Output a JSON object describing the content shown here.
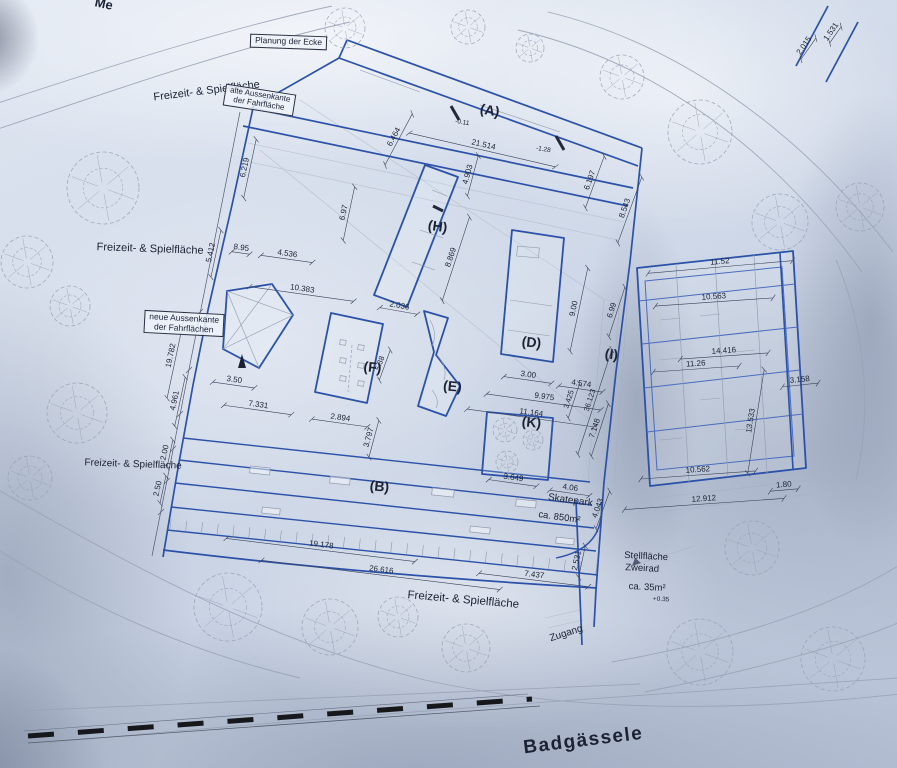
{
  "colors": {
    "plan_blue": "#2b51a8",
    "thin_blue": "#4a6cc0",
    "sketch_gray": "#97a0b4",
    "ink": "#1c2233",
    "dimline": "#39415a",
    "paper": "#ccd6e6",
    "rail_black": "#17181c"
  },
  "plan": {
    "boxes": {
      "planung": {
        "label": "Planung der Ecke"
      },
      "alte": {
        "line1": "alte Aussenkante",
        "line2": "der Fahrfläche"
      },
      "neue": {
        "line1": "neue Aussenkante",
        "line2": "der Fahrflächen"
      }
    },
    "texts": [
      {
        "n": "street-name-top",
        "t": "Me",
        "x": 103,
        "y": 8,
        "r": 12,
        "s": 13,
        "w": 700
      },
      {
        "n": "area-label-top",
        "t": "Freizeit- & Spielfläche",
        "x": 207,
        "y": 94,
        "r": -7,
        "s": 11,
        "w": 500
      },
      {
        "n": "area-label-mid",
        "t": "Freizeit- & Spielfläche",
        "x": 150,
        "y": 252,
        "r": 2,
        "s": 11,
        "w": 500
      },
      {
        "n": "area-label-left",
        "t": "Freizeit- & Spielfläche",
        "x": 133,
        "y": 467,
        "r": 2,
        "s": 10,
        "w": 500
      },
      {
        "n": "area-label-bottom",
        "t": "Freizeit- & Spielfläche",
        "x": 463,
        "y": 603,
        "r": 5,
        "s": 11.5,
        "w": 500
      },
      {
        "n": "street-name-bottom",
        "t": "Badgässele",
        "x": 584,
        "y": 746,
        "r": -7,
        "s": 19,
        "w": 600,
        "ls": 1.5
      },
      {
        "n": "zugang-label",
        "t": "Zugang",
        "x": 567,
        "y": 636,
        "r": -18,
        "s": 10,
        "w": 500
      },
      {
        "n": "skatepark-label",
        "t": "Skatepark",
        "x": 570,
        "y": 503,
        "r": 8,
        "s": 10,
        "w": 500
      },
      {
        "n": "skatepark-area",
        "t": "ca. 850m²",
        "x": 559,
        "y": 520,
        "r": 8,
        "s": 9.5,
        "w": 500
      },
      {
        "n": "stellflaeche-line1",
        "t": "Stellfläche",
        "x": 646,
        "y": 559,
        "r": 3,
        "s": 9.5,
        "w": 500
      },
      {
        "n": "stellflaeche-line2",
        "t": "Zweirad",
        "x": 642,
        "y": 571,
        "r": 3,
        "s": 9.5,
        "w": 500
      },
      {
        "n": "stellflaeche-area",
        "t": "ca. 35m²",
        "x": 647,
        "y": 590,
        "r": 3,
        "s": 9.5,
        "w": 500
      },
      {
        "n": "level-note",
        "t": "+0.35",
        "x": 661,
        "y": 601,
        "r": 3,
        "s": 6.5
      },
      {
        "n": "building-label-a",
        "t": "(A)",
        "x": 489,
        "y": 115,
        "r": 10,
        "s": 14,
        "w": 600
      },
      {
        "n": "building-label-b",
        "t": "(B)",
        "x": 379,
        "y": 491,
        "r": 6,
        "s": 14,
        "w": 600
      },
      {
        "n": "building-label-d",
        "t": "(D)",
        "x": 531,
        "y": 347,
        "r": 6,
        "s": 14,
        "w": 600
      },
      {
        "n": "building-label-e",
        "t": "(E)",
        "x": 452,
        "y": 391,
        "r": 6,
        "s": 14,
        "w": 600
      },
      {
        "n": "building-label-f",
        "t": "(F)",
        "x": 372,
        "y": 372,
        "r": 6,
        "s": 14,
        "w": 600
      },
      {
        "n": "building-label-h",
        "t": "(H)",
        "x": 437,
        "y": 231,
        "r": 8,
        "s": 14,
        "w": 600
      },
      {
        "n": "building-label-i",
        "t": "(I)",
        "x": 611,
        "y": 359,
        "r": 6,
        "s": 14,
        "w": 600
      },
      {
        "n": "building-label-k",
        "t": "(K)",
        "x": 531,
        "y": 427,
        "r": 6,
        "s": 14,
        "w": 600
      },
      {
        "n": "dim-2015",
        "t": "2.015",
        "x": 806,
        "y": 47,
        "r": -55,
        "l": 26
      },
      {
        "n": "dim-1531",
        "t": "1.531",
        "x": 833,
        "y": 33,
        "r": -55,
        "l": 20
      },
      {
        "n": "dim-6219",
        "t": "6.219",
        "x": 247,
        "y": 168,
        "r": -78,
        "l": 60
      },
      {
        "n": "dim-6464",
        "t": "6.464",
        "x": 396,
        "y": 138,
        "r": -62,
        "l": 58
      },
      {
        "n": "dim-21514",
        "t": "21.514",
        "x": 483,
        "y": 147,
        "r": 13,
        "l": 150
      },
      {
        "n": "dim-4903",
        "t": "4.903",
        "x": 470,
        "y": 175,
        "r": -75,
        "l": 42
      },
      {
        "n": "level-a1",
        "t": "-0.11",
        "x": 462,
        "y": 124,
        "r": 10,
        "s": 6.5
      },
      {
        "n": "level-a2",
        "t": "-1.28",
        "x": 543,
        "y": 151,
        "r": 10,
        "s": 6.5
      },
      {
        "n": "dim-895",
        "t": "8.95",
        "x": 241,
        "y": 250,
        "r": 8,
        "l": 18
      },
      {
        "n": "dim-4536",
        "t": "4.536",
        "x": 287,
        "y": 256,
        "r": 8,
        "l": 52
      },
      {
        "n": "dim-5412",
        "t": "5.412",
        "x": 213,
        "y": 253,
        "r": -78,
        "l": 48
      },
      {
        "n": "dim-697",
        "t": "6.97",
        "x": 346,
        "y": 213,
        "r": -78,
        "l": 55
      },
      {
        "n": "dim-8869",
        "t": "8.869",
        "x": 453,
        "y": 258,
        "r": -72,
        "l": 88
      },
      {
        "n": "dim-2036",
        "t": "2.036",
        "x": 399,
        "y": 308,
        "r": 10,
        "l": 38
      },
      {
        "n": "dim-10383",
        "t": "10.383",
        "x": 302,
        "y": 291,
        "r": 8,
        "l": 105
      },
      {
        "n": "dim-19782",
        "t": "19.782",
        "x": 173,
        "y": 356,
        "r": -78,
        "l": 85
      },
      {
        "n": "dim-4961",
        "t": "4.961",
        "x": 177,
        "y": 401,
        "r": -78,
        "l": 50
      },
      {
        "n": "dim-200",
        "t": "2.00",
        "x": 167,
        "y": 453,
        "r": -78,
        "l": 28
      },
      {
        "n": "dim-250",
        "t": "2.50",
        "x": 160,
        "y": 489,
        "r": -78,
        "l": 28
      },
      {
        "n": "dim-350",
        "t": "3.50",
        "x": 234,
        "y": 382,
        "r": 8,
        "l": 42
      },
      {
        "n": "dim-7331",
        "t": "7.331",
        "x": 258,
        "y": 407,
        "r": 8,
        "l": 68
      },
      {
        "n": "dim-2894",
        "t": "2.894",
        "x": 340,
        "y": 420,
        "r": 8,
        "l": 56
      },
      {
        "n": "dim-3797",
        "t": "3.797",
        "x": 371,
        "y": 438,
        "r": -75,
        "l": 38
      },
      {
        "n": "dim-538",
        "t": "5.38",
        "x": 382,
        "y": 364,
        "r": -70,
        "s": 7.5,
        "l": 32
      },
      {
        "n": "dim-300",
        "t": "3.00",
        "x": 528,
        "y": 377,
        "r": 8,
        "l": 48
      },
      {
        "n": "dim-9975",
        "t": "9.975",
        "x": 544,
        "y": 399,
        "r": 8,
        "l": 115
      },
      {
        "n": "dim-11164",
        "t": "11.164",
        "x": 531,
        "y": 415,
        "r": 8,
        "l": 128
      },
      {
        "n": "dim-4574",
        "t": "4.574",
        "x": 581,
        "y": 386,
        "r": 8,
        "l": 44
      },
      {
        "n": "dim-36123",
        "t": "36.123",
        "x": 592,
        "y": 401,
        "r": -72,
        "s": 7.5,
        "l": 110
      },
      {
        "n": "dim-3425",
        "t": "3.425",
        "x": 571,
        "y": 400,
        "r": -72,
        "s": 7.5,
        "l": 36
      },
      {
        "n": "dim-7148",
        "t": "7.148",
        "x": 597,
        "y": 429,
        "r": -72,
        "l": 55
      },
      {
        "n": "dim-900",
        "t": "9.00",
        "x": 576,
        "y": 309,
        "r": -78,
        "l": 85
      },
      {
        "n": "dim-699",
        "t": "6.99",
        "x": 614,
        "y": 311,
        "r": -72,
        "l": 52
      },
      {
        "n": "dim-6197",
        "t": "6.197",
        "x": 592,
        "y": 181,
        "r": -70,
        "l": 55
      },
      {
        "n": "dim-8543",
        "t": "8.543",
        "x": 627,
        "y": 209,
        "r": -70,
        "l": 70
      },
      {
        "n": "dim-3649",
        "t": "3.649",
        "x": 513,
        "y": 480,
        "r": 8,
        "l": 48
      },
      {
        "n": "dim-406",
        "t": "4.06",
        "x": 570,
        "y": 490,
        "r": 8,
        "l": 40
      },
      {
        "n": "dim-4043",
        "t": "4.043",
        "x": 600,
        "y": 509,
        "r": -70,
        "l": 40
      },
      {
        "n": "dim-19178",
        "t": "19.178",
        "x": 321,
        "y": 547,
        "r": 7,
        "l": 190
      },
      {
        "n": "dim-26616",
        "t": "26.616",
        "x": 381,
        "y": 572,
        "r": 7,
        "l": 240
      },
      {
        "n": "dim-7437",
        "t": "7.437",
        "x": 534,
        "y": 577,
        "r": 7,
        "l": 110
      },
      {
        "n": "dim-2531",
        "t": "2.531",
        "x": 579,
        "y": 561,
        "r": -78,
        "l": 32
      },
      {
        "n": "dim-1152",
        "t": "11.52",
        "x": 720,
        "y": 264,
        "r": -5,
        "l": 145
      },
      {
        "n": "dim-10563",
        "t": "10.563",
        "x": 714,
        "y": 299,
        "r": -4,
        "l": 118
      },
      {
        "n": "dim-14416",
        "t": "14.416",
        "x": 724,
        "y": 353,
        "r": -4,
        "l": 88
      },
      {
        "n": "dim-1126",
        "t": "11.26",
        "x": 696,
        "y": 366,
        "r": -4,
        "l": 86
      },
      {
        "n": "dim-3158",
        "t": "3.158",
        "x": 800,
        "y": 382,
        "r": -6,
        "l": 36
      },
      {
        "n": "dim-13533",
        "t": "13.533",
        "x": 753,
        "y": 421,
        "r": -81,
        "l": 105
      },
      {
        "n": "dim-10562",
        "t": "10.562",
        "x": 698,
        "y": 472,
        "r": -4,
        "l": 115
      },
      {
        "n": "dim-180",
        "t": "1.80",
        "x": 784,
        "y": 487,
        "r": -5,
        "l": 28
      },
      {
        "n": "dim-12912",
        "t": "12.912",
        "x": 704,
        "y": 501,
        "r": -4,
        "l": 160
      }
    ],
    "trees": [
      {
        "x": 103,
        "y": 188,
        "r": 36
      },
      {
        "x": 27,
        "y": 262,
        "r": 26
      },
      {
        "x": 70,
        "y": 306,
        "r": 20
      },
      {
        "x": 77,
        "y": 413,
        "r": 30
      },
      {
        "x": 30,
        "y": 478,
        "r": 22
      },
      {
        "x": 228,
        "y": 607,
        "r": 34
      },
      {
        "x": 330,
        "y": 627,
        "r": 28
      },
      {
        "x": 398,
        "y": 617,
        "r": 20
      },
      {
        "x": 466,
        "y": 648,
        "r": 24
      },
      {
        "x": 345,
        "y": 28,
        "r": 20
      },
      {
        "x": 468,
        "y": 27,
        "r": 17
      },
      {
        "x": 530,
        "y": 48,
        "r": 14
      },
      {
        "x": 622,
        "y": 77,
        "r": 22
      },
      {
        "x": 700,
        "y": 132,
        "r": 32
      },
      {
        "x": 780,
        "y": 222,
        "r": 28
      },
      {
        "x": 860,
        "y": 207,
        "r": 24
      },
      {
        "x": 752,
        "y": 548,
        "r": 27
      },
      {
        "x": 700,
        "y": 652,
        "r": 33
      },
      {
        "x": 833,
        "y": 659,
        "r": 32
      },
      {
        "x": 505,
        "y": 430,
        "r": 12
      },
      {
        "x": 533,
        "y": 440,
        "r": 10
      },
      {
        "x": 507,
        "y": 462,
        "r": 11
      }
    ]
  }
}
